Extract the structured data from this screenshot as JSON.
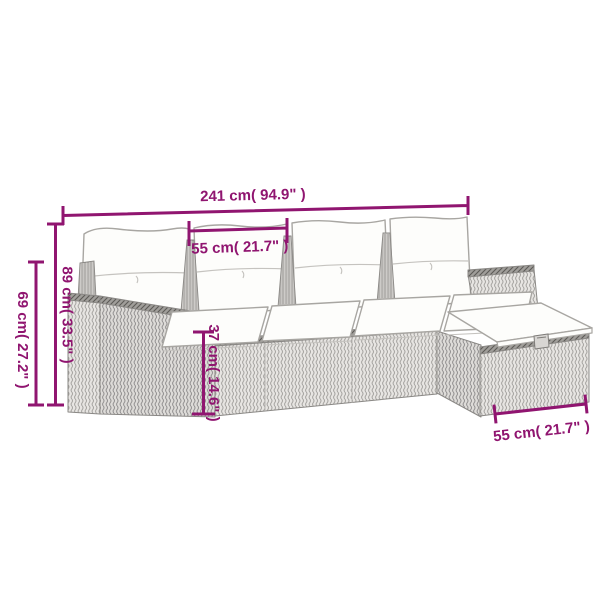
{
  "image": {
    "kind": "product-dimension-diagram",
    "subject": "rattan-l-shaped-garden-sofa-set-with-cushions-and-ottoman"
  },
  "dimensions": {
    "overall_width": {
      "label": "241 cm( 94.9\" )"
    },
    "seat_width_top": {
      "label": "55 cm( 21.7\" )"
    },
    "left_outer_height": {
      "label": "69 cm( 27.2\" )"
    },
    "left_inner_height": {
      "label": "89 cm( 33.5\" )"
    },
    "seat_height": {
      "label": "37 cm( 14.6\" )"
    },
    "ottoman_width": {
      "label": "55 cm( 21.7\" )"
    }
  },
  "colors": {
    "dimension_accent": "#901570",
    "wicker_light": "#e7e5e2",
    "wicker_side": "#dddbd8",
    "wicker_dark_edge": "#a09e9a",
    "cushion_white": "#fdfdfb",
    "outline_gray": "#8a8885",
    "background": "#ffffff"
  }
}
